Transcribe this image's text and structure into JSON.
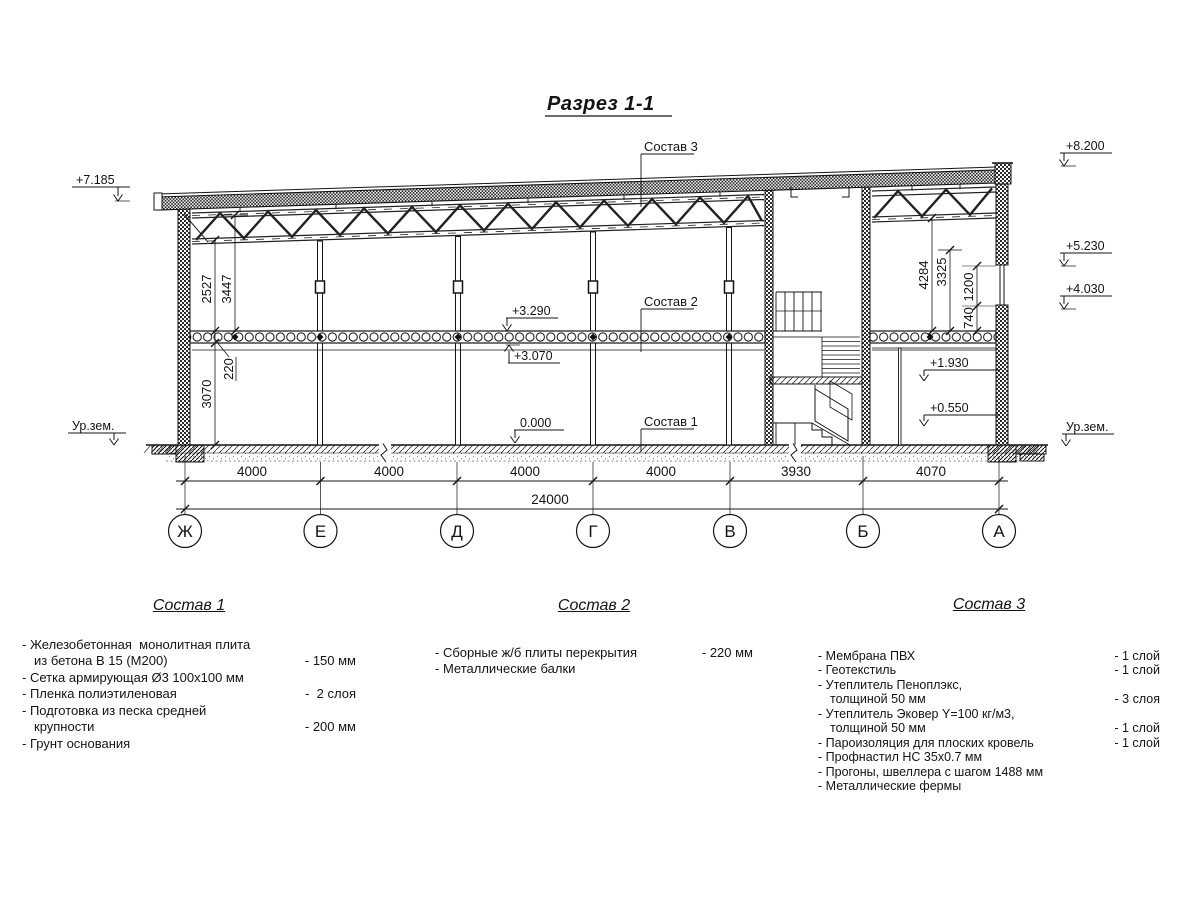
{
  "title": "Разрез 1-1",
  "drawing": {
    "elevations": {
      "roof_left": "+7.185",
      "parapet_right": "+8.200",
      "truss_right": "+5.230",
      "beam_right": "+4.030",
      "ground_left": "Ур.зем.",
      "ground_right": "Ур.зем.",
      "landing_upper": "+1.930",
      "landing_lower": "+0.550",
      "slab_top": "+3.290",
      "slab_bottom": "+3.070",
      "floor_zero": "0.000"
    },
    "callouts": {
      "c1": "Состав 1",
      "c2": "Состав 2",
      "c3": "Состав 3"
    },
    "vdims": {
      "truss_clear_left": "2527",
      "roof_clear_left": "3447",
      "slab_thickness": "220",
      "ground_floor_height": "3070",
      "truss_clear_right": "4284",
      "beam_clear_right": "3325",
      "window_height": "1200",
      "window_sill": "740"
    },
    "spans": [
      "4000",
      "4000",
      "4000",
      "4000",
      "3930",
      "4070"
    ],
    "total_span": "24000",
    "axes": [
      "Ж",
      "Е",
      "Д",
      "Г",
      "В",
      "Б",
      "А"
    ]
  },
  "comp1": {
    "title": "Состав 1",
    "items": [
      {
        "text": "- Железобетонная  монолитная плита",
        "value": ""
      },
      {
        "text": "из бетона В 15 (М200)",
        "value": "- 150 мм"
      },
      {
        "text": "- Сетка армирующая Ø3 100х100 мм",
        "value": ""
      },
      {
        "text": "- Пленка полиэтиленовая",
        "value": "-  2 слоя"
      },
      {
        "text": "- Подготовка из песка средней",
        "value": ""
      },
      {
        "text": "крупности",
        "value": "- 200 мм"
      },
      {
        "text": "- Грунт основания",
        "value": ""
      }
    ]
  },
  "comp2": {
    "title": "Состав 2",
    "items": [
      {
        "text": "- Сборные ж/б плиты перекрытия",
        "value": "- 220 мм"
      },
      {
        "text": "- Металлические балки",
        "value": ""
      }
    ]
  },
  "comp3": {
    "title": "Состав 3",
    "items": [
      {
        "text": "- Мембрана ПВХ",
        "value": "- 1 слой"
      },
      {
        "text": "- Геотекстиль",
        "value": "- 1 слой"
      },
      {
        "text": "- Утеплитель Пеноплэкс,",
        "value": ""
      },
      {
        "text": "толщиной 50 мм",
        "value": "- 3 слоя"
      },
      {
        "text": "- Утеплитель Эковер Y=100 кг/м3,",
        "value": ""
      },
      {
        "text": "толщиной 50 мм",
        "value": "- 1 слой"
      },
      {
        "text": "- Пароизоляция для плоских кровель",
        "value": "- 1 слой"
      },
      {
        "text": "- Профнастил НС 35х0.7 мм",
        "value": ""
      },
      {
        "text": "- Прогоны, швеллера с шагом 1488 мм",
        "value": ""
      },
      {
        "text": "- Металлические фермы",
        "value": ""
      }
    ]
  }
}
